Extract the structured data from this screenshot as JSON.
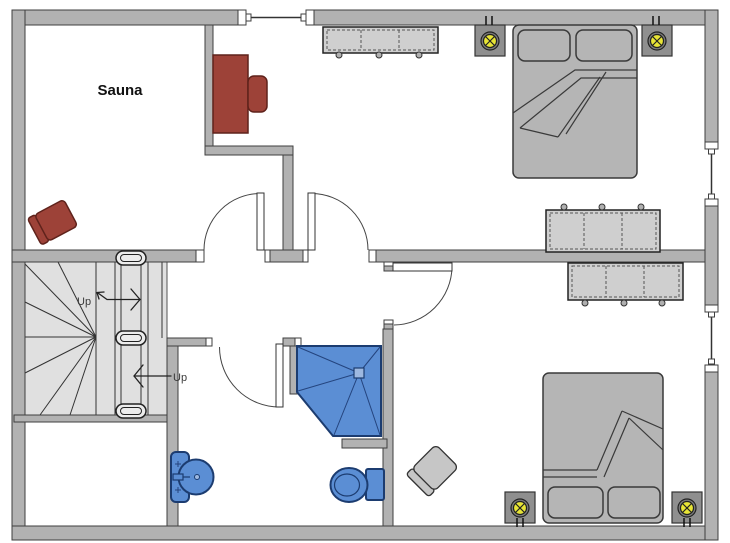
{
  "plan": {
    "rooms": {
      "sauna_label": "Sauna",
      "stairs_up_label_upper": "Up",
      "stairs_up_label_lower": "Up"
    },
    "fixtures": [
      "staircase-with-winders",
      "double-bed",
      "pillow",
      "nightstand",
      "table-lamp",
      "outlet-mark",
      "dresser",
      "sideboard",
      "corner-shower",
      "shower-drain",
      "wash-basin",
      "toilet",
      "armchair-red",
      "armchair-gray",
      "desk-with-chair",
      "hinged-door",
      "window"
    ],
    "colors": {
      "wall": "#b2b2b2",
      "wall_outline": "#3f3f3f",
      "stairs_fill": "#e0e0e0",
      "furniture_gray": "#b5b5b5",
      "nightstand_gray": "#8f8f8f",
      "dresser_gray": "#cfcfcf",
      "armchair_gray": "#c6c6c6",
      "accent_red": "#9d4238",
      "accent_red_outline": "#5f221b",
      "plumbing_blue": "#5b8ed4",
      "plumbing_blue_outline": "#1c3c70",
      "drain_blue": "#9db8e0",
      "lamp_yellow": "#e8e536",
      "background": "#ffffff"
    }
  }
}
